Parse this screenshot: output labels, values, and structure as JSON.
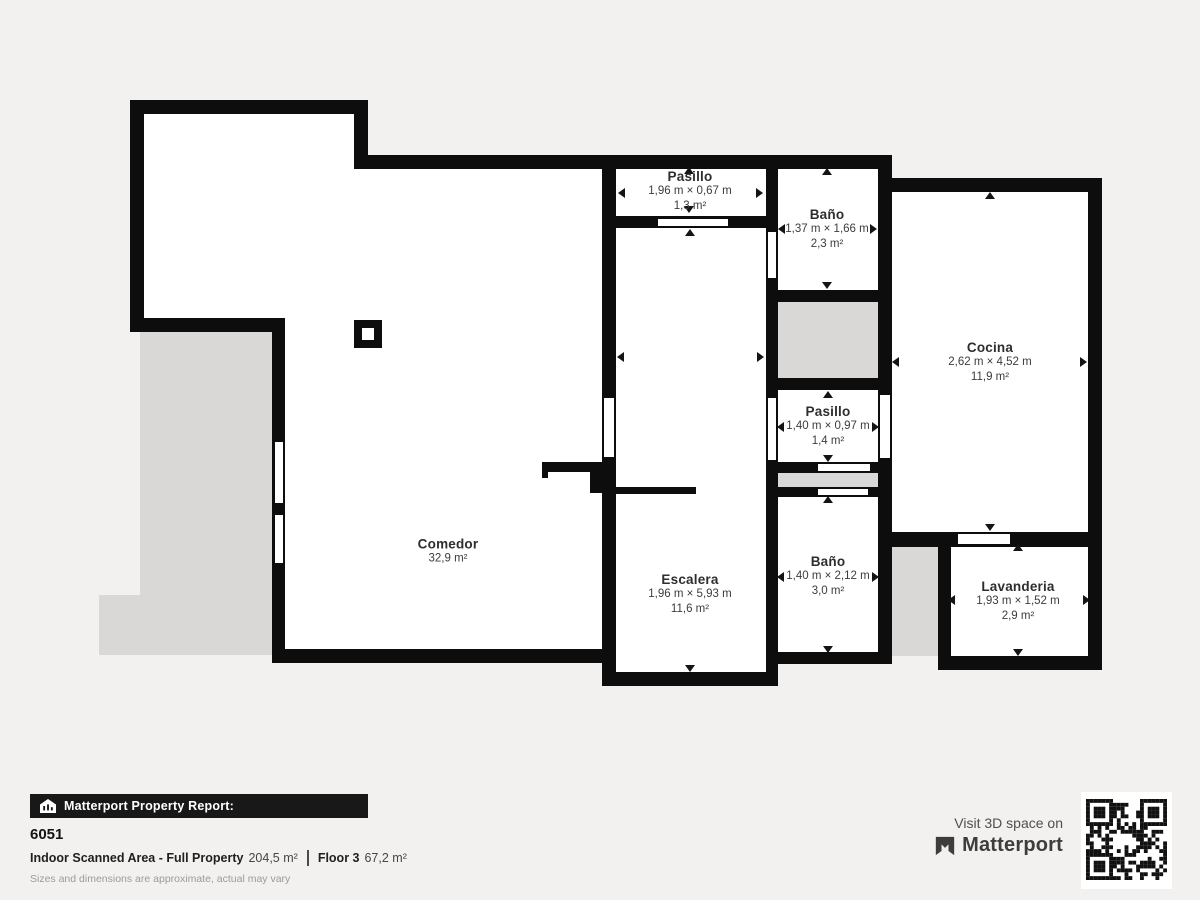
{
  "plan": {
    "rooms": {
      "pasillo_top": {
        "name": "Pasillo",
        "dims": "1,96 m × 0,67 m",
        "area": "1,3 m²"
      },
      "bano_top": {
        "name": "Baño",
        "dims": "1,37 m × 1,66 m",
        "area": "2,3 m²"
      },
      "cocina": {
        "name": "Cocina",
        "dims": "2,62 m × 4,52 m",
        "area": "11,9 m²"
      },
      "pasillo_mid": {
        "name": "Pasillo",
        "dims": "1,40 m × 0,97 m",
        "area": "1,4 m²"
      },
      "comedor": {
        "name": "Comedor",
        "area": "32,9 m²"
      },
      "escalera": {
        "name": "Escalera",
        "dims": "1,96 m × 5,93 m",
        "area": "11,6 m²"
      },
      "bano_mid": {
        "name": "Baño",
        "dims": "1,40 m × 2,12 m",
        "area": "3,0 m²"
      },
      "lavanderia": {
        "name": "Lavanderia",
        "dims": "1,93 m × 1,52 m",
        "area": "2,9 m²"
      }
    }
  },
  "footer": {
    "report_label": "Matterport Property Report:",
    "property_id": "6051",
    "scanned_area_label": "Indoor Scanned Area - Full Property",
    "scanned_area_value": "204,5 m²",
    "floor_label": "Floor 3",
    "floor_value": "67,2 m²",
    "disclaimer": "Sizes and dimensions are approximate, actual may vary",
    "visit_text": "Visit 3D space on",
    "brand_name": "Matterport"
  },
  "icons": {
    "report_bar_icon": "house-report-icon",
    "brand_icon": "matterport-logo-icon",
    "qr": "qr-code"
  },
  "colors": {
    "wall": "#0d0d0d",
    "room_white": "#ffffff",
    "unscanned_gray": "#d9d8d6",
    "background": "#f2f1ef",
    "report_bar_bg": "#181818"
  }
}
